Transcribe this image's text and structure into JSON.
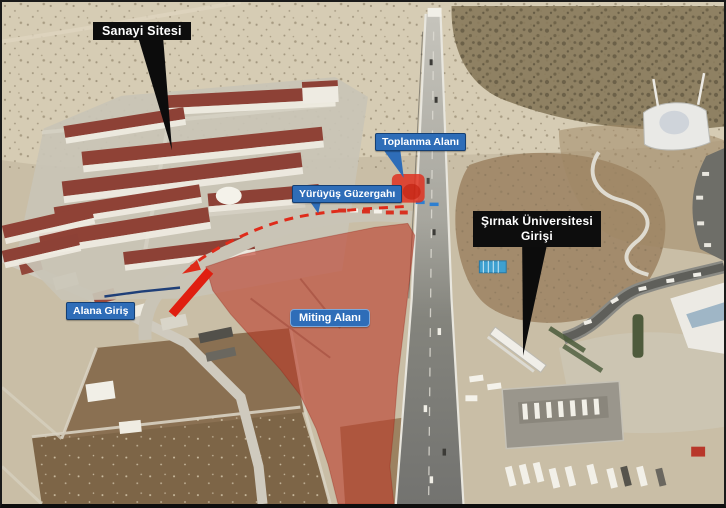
{
  "annotations": {
    "sanayi_sitesi": {
      "label": "Sanayi Sitesi",
      "style": "black-flag"
    },
    "toplanma_alani": {
      "label": "Toplanma Alanı",
      "style": "blue-flag"
    },
    "yuruyus_guzergahi": {
      "label": "Yürüyüş Güzergahı",
      "style": "blue-flag"
    },
    "sirnak_universitesi_girisi": {
      "line1": "Şırnak Üniversitesi",
      "line2": "Girişi",
      "style": "black-flag"
    },
    "alana_giris": {
      "label": "Alana Giriş",
      "style": "blue-flag"
    },
    "miting_alani": {
      "label": "Miting Alanı",
      "style": "blue-badge"
    }
  },
  "colors": {
    "label_blue": "#2e6db8",
    "label_black": "#0d0d0d",
    "label_text": "#ffffff",
    "rally_area_red": "rgba(188,55,38,0.58)",
    "route_dash_red": "#df2b1a",
    "entrance_bar_red": "#e01e10",
    "assembly_marker_red": "rgba(225,45,28,0.82)"
  }
}
